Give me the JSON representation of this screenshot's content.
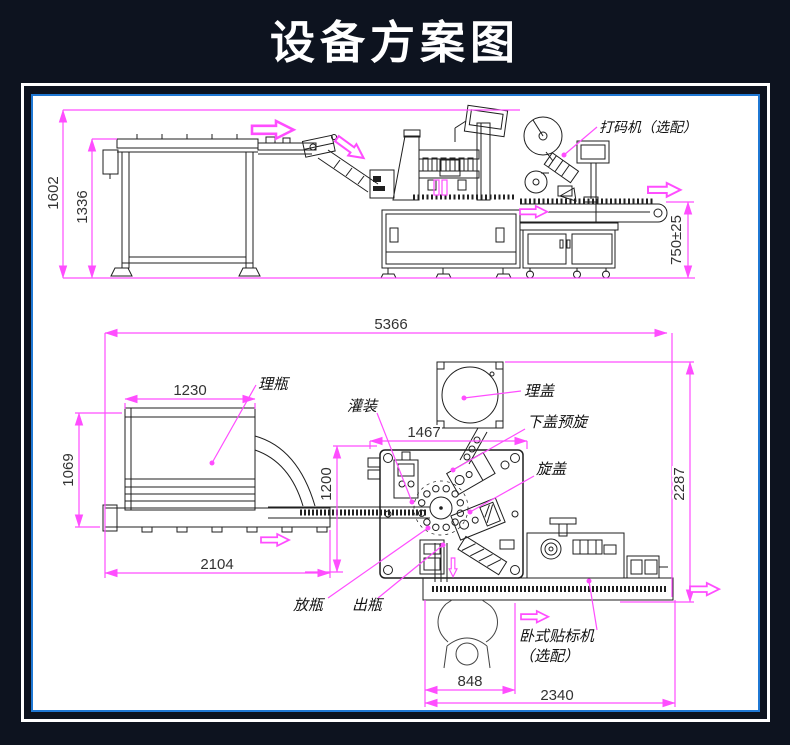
{
  "page": {
    "title": "设备方案图",
    "colors": {
      "background": "#0d131f",
      "frame": "#ffffff",
      "panel_border": "#1f78d4",
      "panel_bg": "#ffffff",
      "dimension_lines": "#ff4dff",
      "linework": "#1f1f1f"
    }
  },
  "top_view": {
    "dimensions": {
      "total_height": "1602",
      "table_height": "1336",
      "conveyor_height": "750±25"
    },
    "labels": {
      "coder": "打码机（选配）"
    }
  },
  "bottom_view": {
    "dimensions": {
      "total_length": "5366",
      "unscrambler_width": "1230",
      "unscrambler_depth": "1069",
      "infeed_conveyor_length": "2104",
      "monoblock_depth": "1200",
      "monoblock_width": "1467",
      "outfeed_depth": "2287",
      "workstation_width": "848",
      "outfeed_length": "2340"
    },
    "labels": {
      "unscrambler": "理瓶",
      "filling": "灌装",
      "cap_sorter": "理盖",
      "cap_prescrew": "下盖预旋",
      "capping": "旋盖",
      "bottle_in": "放瓶",
      "bottle_out": "出瓶",
      "labeler_line1": "卧式贴标机",
      "labeler_line2": "（选配）"
    }
  }
}
